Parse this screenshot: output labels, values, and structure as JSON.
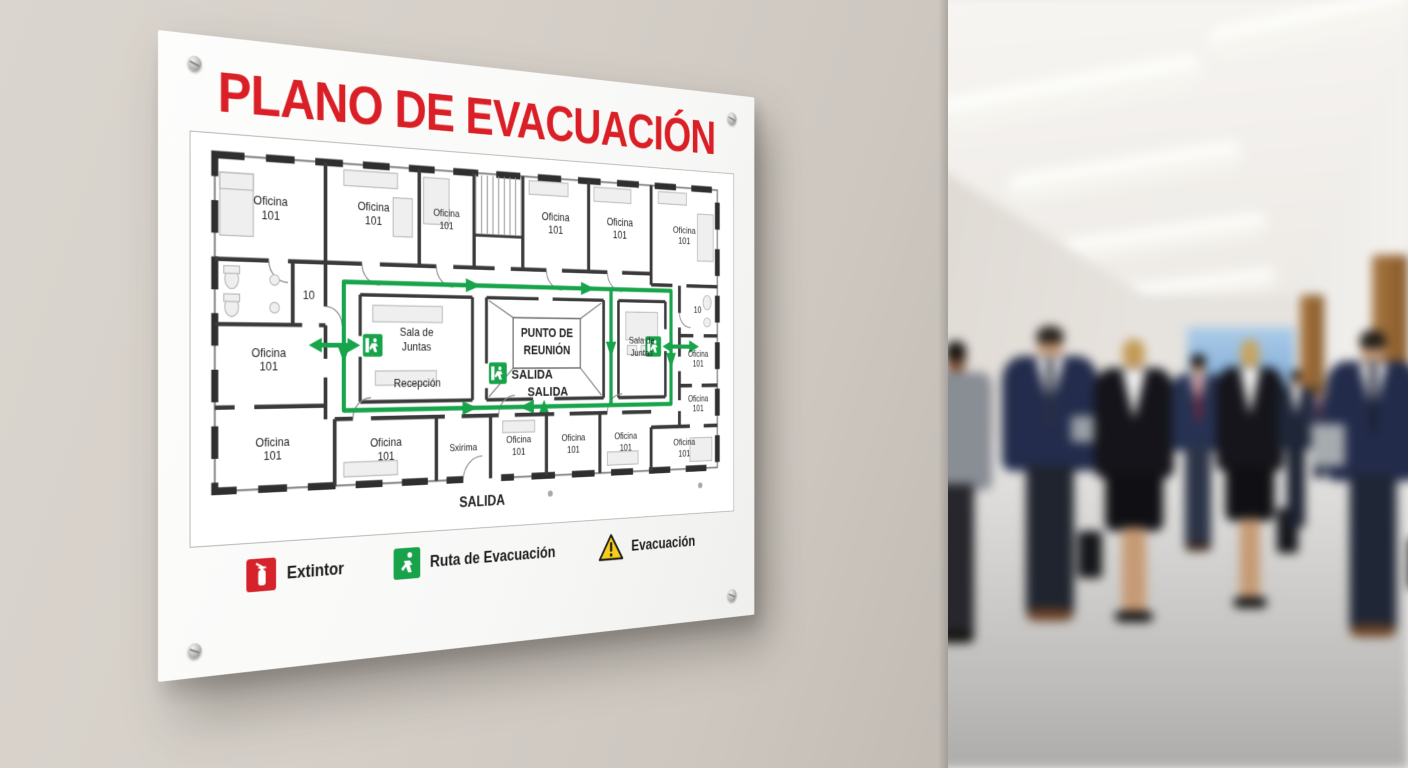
{
  "sign": {
    "title": "PLANO DE EVACUACIÓN",
    "plan": {
      "office": {
        "l1": "Oficina",
        "l2": "101"
      },
      "small_room": "10",
      "garbled_room": "Sxirima",
      "sala": {
        "l1": "Sala de",
        "l2": "Juntas"
      },
      "recepcion": "Recepción",
      "punto": {
        "l1": "PUNTO DE",
        "l2": "REUNIÓN"
      },
      "salida": "SALIDA"
    },
    "legend": {
      "items": [
        {
          "icon": "fire-extinguisher-icon",
          "label": "Extintor"
        },
        {
          "icon": "exit-running-man-icon",
          "label": "Ruta de Evacuación"
        },
        {
          "icon": "warning-triangle-icon",
          "label": "Evacuación"
        }
      ]
    },
    "colors": {
      "title_red": "#da1f26",
      "route_green": "#17a44b",
      "extinguisher_red": "#d6222a",
      "warning_yellow": "#f7cd1d",
      "wall_line": "#3a3a3a"
    }
  }
}
